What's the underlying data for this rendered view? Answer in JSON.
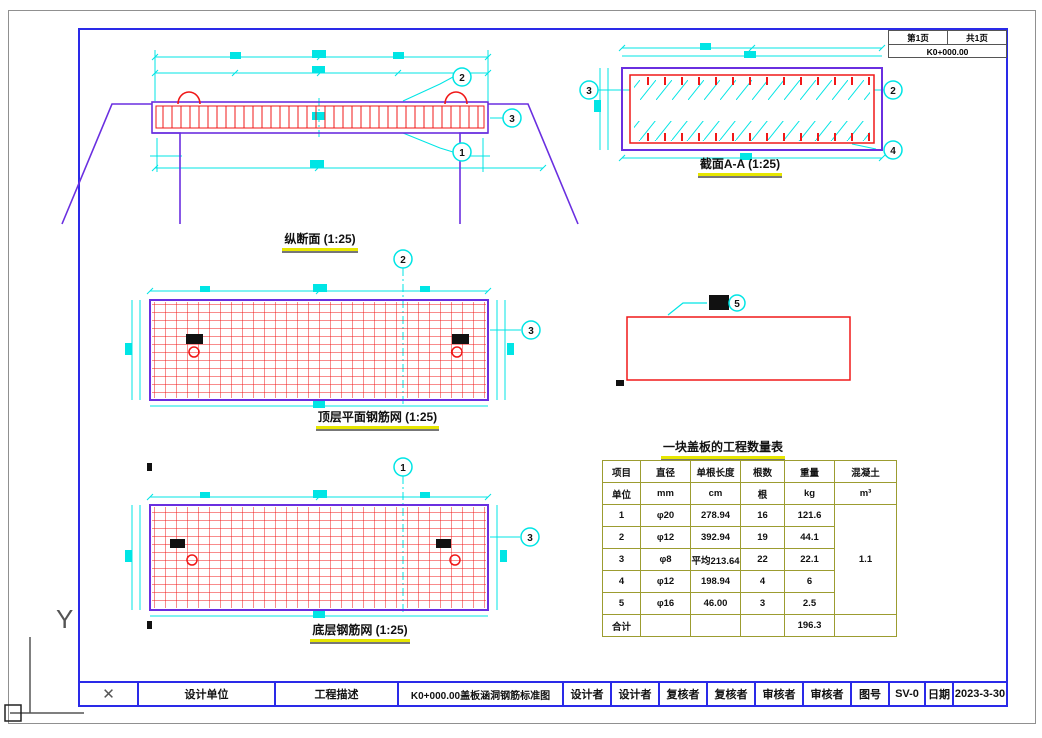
{
  "icons": {
    "x_mark": "✕"
  },
  "page": {
    "top_right_box": {
      "page_no": "第1页",
      "total_pages": "共1页",
      "station": "K0+000.00"
    },
    "title_bar": {
      "design_unit": "设计单位",
      "project_desc": "工程描述",
      "drawing_title": "K0+000.00盖板涵洞钢筋标准图",
      "designer_label": "设计者",
      "designer_value": "设计者",
      "checker_label": "复核者",
      "checker_value": "复核者",
      "reviewer_label": "审核者",
      "reviewer_value": "审核者",
      "drawing_no_label": "图号",
      "drawing_no": "SV-0",
      "date_label": "日期",
      "date": "2023-3-30"
    },
    "ucs": {
      "y_label": "Y"
    }
  },
  "views": {
    "longitudinal": {
      "caption": "纵断面 (1:25)"
    },
    "section": {
      "caption": "截面A-A (1:25)"
    },
    "top_mesh": {
      "caption": "顶层平面钢筋网 (1:25)"
    },
    "bottom_mesh": {
      "caption": "底层钢筋网 (1:25)"
    }
  },
  "callouts": {
    "n1": "1",
    "n2": "2",
    "n3": "3",
    "n4": "4",
    "n5": "5"
  },
  "qty_table": {
    "title": "一块盖板的工程数量表",
    "rows": [
      [
        "项目",
        "直径",
        "单根长度",
        "根数",
        "重量",
        "混凝土"
      ],
      [
        "单位",
        "mm",
        "cm",
        "根",
        "kg",
        "m³"
      ],
      [
        "1",
        "φ20",
        "278.94",
        "16",
        "121.6",
        "1.1"
      ],
      [
        "2",
        "φ12",
        "392.94",
        "19",
        "44.1",
        ""
      ],
      [
        "3",
        "φ8",
        "平均213.64",
        "22",
        "22.1",
        ""
      ],
      [
        "4",
        "φ12",
        "198.94",
        "4",
        "6",
        ""
      ],
      [
        "5",
        "φ16",
        "46.00",
        "3",
        "2.5",
        ""
      ],
      [
        "合计",
        "",
        "",
        "",
        "196.3",
        ""
      ]
    ]
  },
  "colors": {
    "dim_cyan": "#00E5E5",
    "rebar_red": "#F01818",
    "structure_purple": "#6A2FE0",
    "frame_blue": "#2A2AE8",
    "table_line": "#9C9C30",
    "caption_underline": "#E6E600"
  }
}
